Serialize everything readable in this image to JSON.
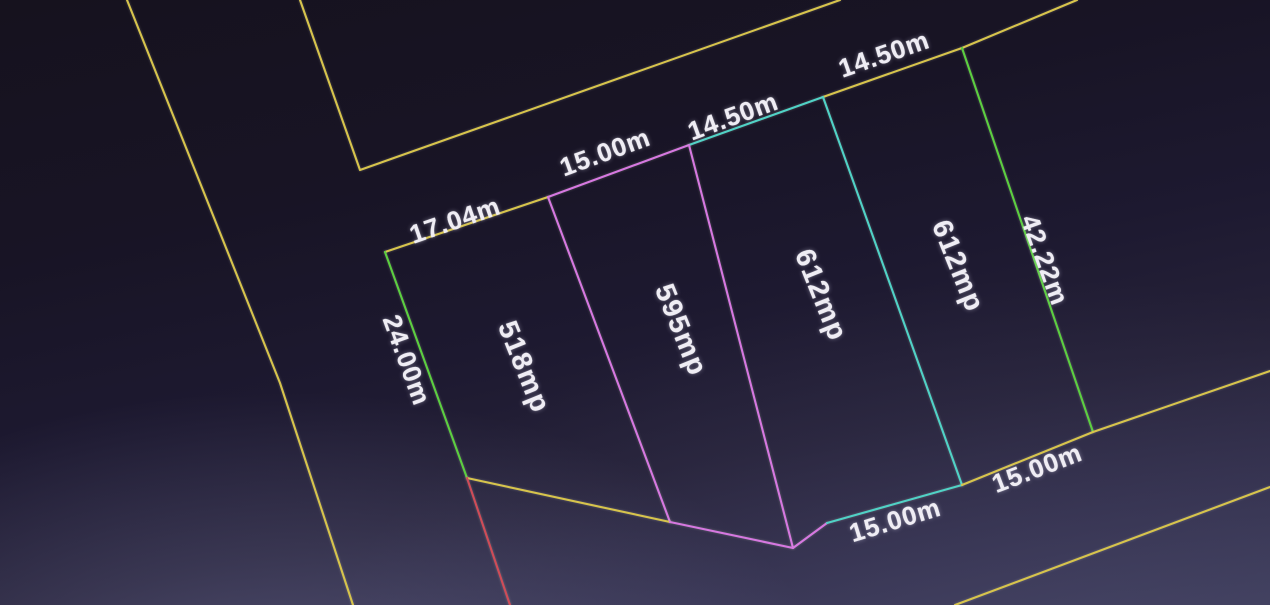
{
  "app": {
    "view_title": "cadastral-parcel-plan"
  },
  "colors": {
    "yellow": "#d7c44c",
    "green": "#5ccf40",
    "magenta": "#d678e0",
    "cyan": "#50d2c6",
    "red": "#cf4c58",
    "text": "#efedf4",
    "background_dark": "#16121e",
    "background_light": "#3c3b58"
  },
  "parcels": [
    {
      "area": "518mp",
      "frontage": "17.04m",
      "left_side": "24.00m"
    },
    {
      "area": "595mp",
      "frontage": "15.00m",
      "rear": "15.00m"
    },
    {
      "area": "612mp",
      "frontage": "14.50m",
      "rear": "15.00m"
    },
    {
      "area": "612mp",
      "frontage": "14.50m",
      "right_side": "42.22m",
      "rear": "15.00m"
    }
  ],
  "plan": {
    "lines": [
      {
        "name": "road-west-outer-line",
        "color": "yellow",
        "points": [
          [
            127,
            0
          ],
          [
            280,
            383
          ],
          [
            353,
            605
          ]
        ]
      },
      {
        "name": "road-west-inner-line",
        "color": "yellow",
        "points": [
          [
            300,
            0
          ],
          [
            360,
            170
          ],
          [
            840,
            0
          ]
        ]
      },
      {
        "name": "parcel-top-edge-17m",
        "color": "yellow",
        "points": [
          [
            385,
            252
          ],
          [
            548,
            197
          ]
        ]
      },
      {
        "name": "parcel-top-edge-15m",
        "color": "magenta",
        "points": [
          [
            548,
            197
          ],
          [
            689,
            145
          ]
        ]
      },
      {
        "name": "parcel-top-edge-14m-cyan",
        "color": "cyan",
        "points": [
          [
            689,
            145
          ],
          [
            823,
            97
          ]
        ]
      },
      {
        "name": "parcel-top-edge-14m-yellow",
        "color": "yellow",
        "points": [
          [
            823,
            97
          ],
          [
            962,
            48
          ],
          [
            1077,
            0
          ]
        ]
      },
      {
        "name": "parcel-left-edge-24m",
        "color": "green",
        "points": [
          [
            385,
            252
          ],
          [
            467,
            478
          ]
        ]
      },
      {
        "name": "parcel-right-edge-42m",
        "color": "green",
        "points": [
          [
            962,
            48
          ],
          [
            1093,
            432
          ]
        ]
      },
      {
        "name": "divider-518-595",
        "color": "magenta",
        "points": [
          [
            548,
            197
          ],
          [
            670,
            522
          ]
        ]
      },
      {
        "name": "divider-595-612",
        "color": "magenta",
        "points": [
          [
            689,
            145
          ],
          [
            793,
            548
          ]
        ]
      },
      {
        "name": "divider-612-612",
        "color": "cyan",
        "points": [
          [
            823,
            97
          ],
          [
            962,
            485
          ]
        ]
      },
      {
        "name": "parcel-bottom-edge-518",
        "color": "yellow",
        "points": [
          [
            467,
            478
          ],
          [
            670,
            522
          ]
        ]
      },
      {
        "name": "parcel-bottom-edge-595",
        "color": "magenta",
        "points": [
          [
            670,
            522
          ],
          [
            793,
            548
          ],
          [
            827,
            523
          ]
        ]
      },
      {
        "name": "parcel-bottom-edge-612",
        "color": "cyan",
        "points": [
          [
            827,
            523
          ],
          [
            962,
            485
          ]
        ]
      },
      {
        "name": "road-south-inner-line",
        "color": "yellow",
        "points": [
          [
            962,
            485
          ],
          [
            1093,
            432
          ],
          [
            1270,
            371
          ]
        ]
      },
      {
        "name": "road-south-outer-line",
        "color": "yellow",
        "points": [
          [
            955,
            605
          ],
          [
            1270,
            487
          ]
        ]
      },
      {
        "name": "red-boundary-line",
        "color": "red",
        "points": [
          [
            467,
            478
          ],
          [
            510,
            605
          ]
        ]
      }
    ],
    "labels": [
      {
        "name": "dim-17-04m",
        "kind": "dimension",
        "text": "17.04m",
        "x": 455,
        "y": 220,
        "rot": -19
      },
      {
        "name": "dim-15-00m-top",
        "kind": "dimension",
        "text": "15.00m",
        "x": 605,
        "y": 152,
        "rot": -20
      },
      {
        "name": "dim-14-50m-cyan",
        "kind": "dimension",
        "text": "14.50m",
        "x": 733,
        "y": 116,
        "rot": -20
      },
      {
        "name": "dim-14-50m-right",
        "kind": "dimension",
        "text": "14.50m",
        "x": 884,
        "y": 54,
        "rot": -19
      },
      {
        "name": "dim-24-00m",
        "kind": "dimension",
        "text": "24.00m",
        "x": 407,
        "y": 360,
        "rot": 70
      },
      {
        "name": "dim-42-22m",
        "kind": "dimension",
        "text": "42.22m",
        "x": 1045,
        "y": 260,
        "rot": 70
      },
      {
        "name": "area-label-518mp",
        "kind": "area",
        "text": "518mp",
        "x": 524,
        "y": 367,
        "rot": 68
      },
      {
        "name": "area-label-595mp",
        "kind": "area",
        "text": "595mp",
        "x": 681,
        "y": 330,
        "rot": 68
      },
      {
        "name": "area-label-612mp-a",
        "kind": "area",
        "text": "612mp",
        "x": 821,
        "y": 295,
        "rot": 68
      },
      {
        "name": "area-label-612mp-b",
        "kind": "area",
        "text": "612mp",
        "x": 958,
        "y": 266,
        "rot": 68
      },
      {
        "name": "dim-15-00m-bottom-cyan",
        "kind": "dimension",
        "text": "15.00m",
        "x": 895,
        "y": 520,
        "rot": -17
      },
      {
        "name": "dim-15-00m-bottom-yellow",
        "kind": "dimension",
        "text": "15.00m",
        "x": 1037,
        "y": 468,
        "rot": -21
      }
    ]
  }
}
